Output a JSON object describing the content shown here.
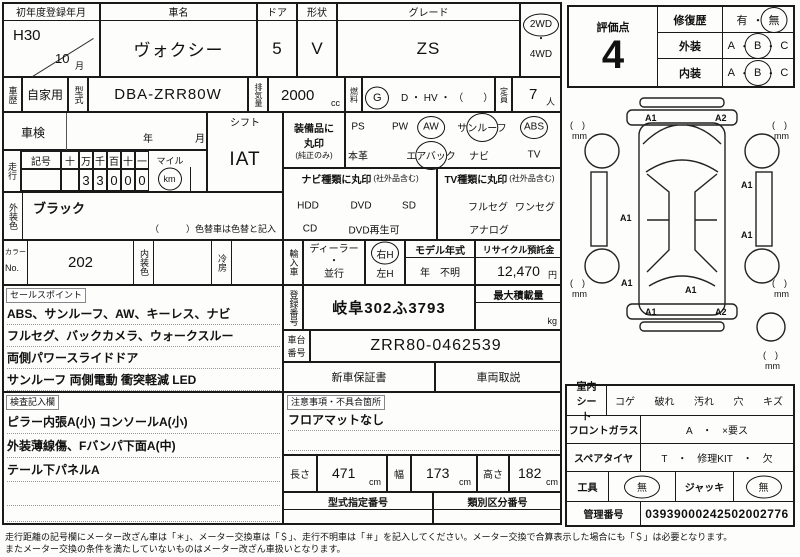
{
  "header": {
    "reg_label": "初年度登録年月",
    "reg_year": "H30",
    "reg_month": "10",
    "month_suffix": "月",
    "name_label": "車名",
    "name_value": "ヴォクシー",
    "door_label": "ドア",
    "door_value": "5",
    "shape_label": "形状",
    "shape_value": "V",
    "grade_label": "グレード",
    "grade_value": "ZS",
    "drive_2wd": "2WD",
    "dot": "・",
    "drive_4wd": "4WD"
  },
  "row2": {
    "history_label": "車歴",
    "history_value": "自家用",
    "model_label": "型式",
    "model_value": "DBA-ZRR80W",
    "disp_label": "排気量",
    "disp_value": "2000",
    "disp_unit": "cc",
    "fuel_label": "燃料",
    "fuel_g": "G",
    "fuel_rest": "D ・ HV ・ （　　）",
    "cap_label": "定員",
    "cap_value": "7",
    "cap_unit": "人"
  },
  "shaken": {
    "label": "車検",
    "year_label": "年",
    "month_label": "月"
  },
  "shift": {
    "label": "シフト",
    "value": "IAT"
  },
  "mileage": {
    "label": "走行",
    "symbol_label": "記号",
    "digit_headers": [
      "十",
      "万",
      "千",
      "百",
      "十",
      "一"
    ],
    "digits": [
      "",
      "3",
      "3",
      "0",
      "0",
      "0"
    ],
    "mile_label": "マイル",
    "km_label": "km"
  },
  "exterior": {
    "label": "外装色",
    "value": "ブラック",
    "note": "（　　　）色替車は色替と記入"
  },
  "color_row": {
    "color_label": "カラー",
    "no_label": "No.",
    "color_no": "202",
    "interior_label": "内装色",
    "ac_label": "冷房"
  },
  "sales_points": {
    "label": "セールスポイント",
    "lines": [
      "ABS、サンルーフ、AW、キーレス、ナビ",
      "フルセグ、バックカメラ、ウォークスルー",
      "両側パワースライドドア",
      "サンルーフ 両側電動 衝突軽減 LED"
    ]
  },
  "inspector_notes": {
    "label": "検査記入欄",
    "lines": [
      "ピラー内張A(小) コンソールA(小)",
      "外装薄線傷、Fバンパ下面A(中)",
      "テール下パネルA"
    ]
  },
  "equipment": {
    "label": "装備品に丸印",
    "sublabel": "(純正のみ)",
    "row1": [
      "PS",
      "PW",
      "AW",
      "サンルーフ",
      "ABS"
    ],
    "row2": [
      "本革",
      "エアバック",
      "ナビ",
      "TV"
    ],
    "circled": [
      "AW",
      "サンルーフ",
      "ABS",
      "エアバック"
    ]
  },
  "nav_type": {
    "label": "ナビ種類に丸印",
    "sublabel": "(社外品含む)",
    "row1": [
      "HDD",
      "DVD",
      "SD"
    ],
    "row2": [
      "CD",
      "DVD再生可"
    ]
  },
  "tv_type": {
    "label": "TV種類に丸印",
    "sublabel": "(社外品含む)",
    "row1": [
      "フルセグ",
      "ワンセグ"
    ],
    "row2": [
      "アナログ"
    ]
  },
  "import": {
    "label": "輸入車",
    "dealer": "ディーラー",
    "dot": "・",
    "parallel": "並行",
    "rh": "右H",
    "lh": "左H",
    "model_year_label": "モデル年式",
    "year_char": "年",
    "year_value": "不明",
    "recycle_label": "リサイクル預託金",
    "recycle_value": "12,470",
    "recycle_unit": "円"
  },
  "registration": {
    "label": "登録番号",
    "value": "岐阜302ふ3793",
    "max_load_label": "最大積載量",
    "max_load_unit": "kg"
  },
  "chassis": {
    "label": "車台番号",
    "value": "ZRR80-0462539"
  },
  "docs": {
    "warranty": "新車保証書",
    "manual": "車両取説"
  },
  "notes": {
    "label": "注意事項・不具合箇所",
    "value": "フロアマットなし"
  },
  "dims": {
    "length_label": "長さ",
    "length": "471",
    "width_label": "幅",
    "width": "173",
    "height_label": "高さ",
    "height": "182",
    "unit": "cm"
  },
  "type_numbers": {
    "designation_label": "型式指定番号",
    "classification_label": "類別区分番号"
  },
  "score": {
    "label": "評価点",
    "value": "4",
    "repair_label": "修復歴",
    "repair_yes": "有",
    "repair_no": "無",
    "exterior_label": "外装",
    "interior_label": "内装",
    "a": "A",
    "b": "B",
    "c": "C",
    "dot": "・"
  },
  "diagram": {
    "paren": "(　)",
    "mm": "mm",
    "front_left": "A1",
    "front_right": "A2",
    "left_mid": "A1",
    "right_upper": "A1",
    "right_lower": "A1",
    "rear_left": "A1",
    "rear_center": "A1",
    "rear_strip_left": "A1",
    "rear_strip_right": "A2"
  },
  "interior_sheet": {
    "label": "室内シート",
    "items": [
      "コゲ",
      "破れ",
      "汚れ",
      "穴",
      "キズ"
    ]
  },
  "windshield": {
    "label": "フロントガラス",
    "value": "A　・　×要ス"
  },
  "spare": {
    "label": "スペアタイヤ",
    "value": "T　・　修理KIT　・　欠"
  },
  "tools": {
    "label": "工具",
    "value": "無",
    "jack_label": "ジャッキ",
    "jack_value": "無"
  },
  "management": {
    "label": "管理番号",
    "value": "03939000242502002776"
  },
  "footer": {
    "line1": "走行距離の記号欄にメーター改ざん車は「＊」、メーター交換車は「＄」、走行不明車は「＃」を記入してください。メーター交換で合算表示した場合にも「＄」は必要となります。",
    "line2": "またメーター交換の条件を満たしていないものはメーター改ざん車扱いとなります。"
  }
}
